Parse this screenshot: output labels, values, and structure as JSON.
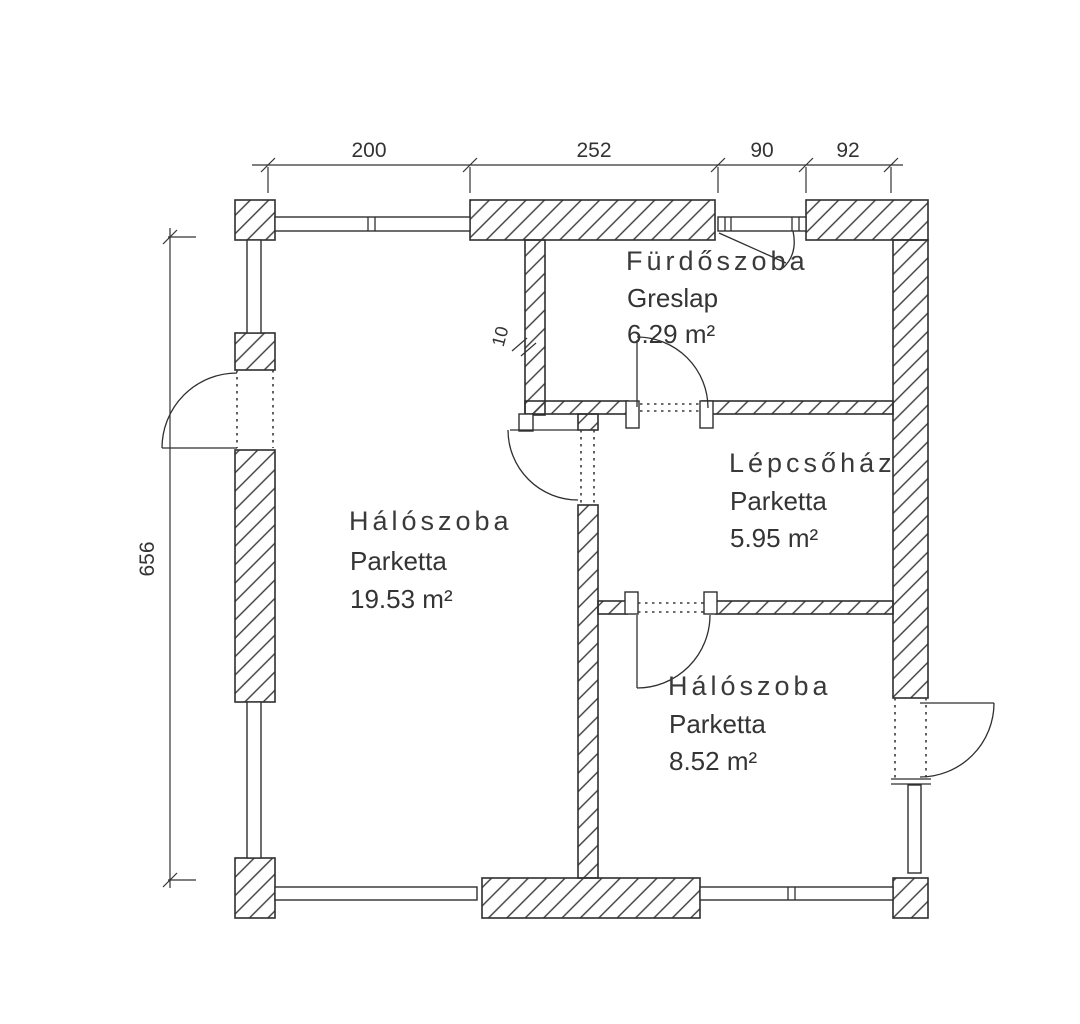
{
  "plan": {
    "rooms": [
      {
        "name": "Fürdőszoba",
        "floor": "Greslap",
        "area": "6.29 m²"
      },
      {
        "name": "Hálószoba",
        "floor": "Parketta",
        "area": "19.53 m²"
      },
      {
        "name": "Lépcsőház",
        "floor": "Parketta",
        "area": "5.95 m²"
      },
      {
        "name": "Hálószoba",
        "floor": "Parketta",
        "area": "8.52 m²"
      }
    ],
    "dimensions": {
      "top_segments": [
        "200",
        "252",
        "90",
        "92"
      ],
      "left_height": "656",
      "partition_thickness": "10"
    },
    "colors": {
      "line": "#2f2f2f",
      "text": "#343434",
      "background": "#ffffff"
    }
  }
}
